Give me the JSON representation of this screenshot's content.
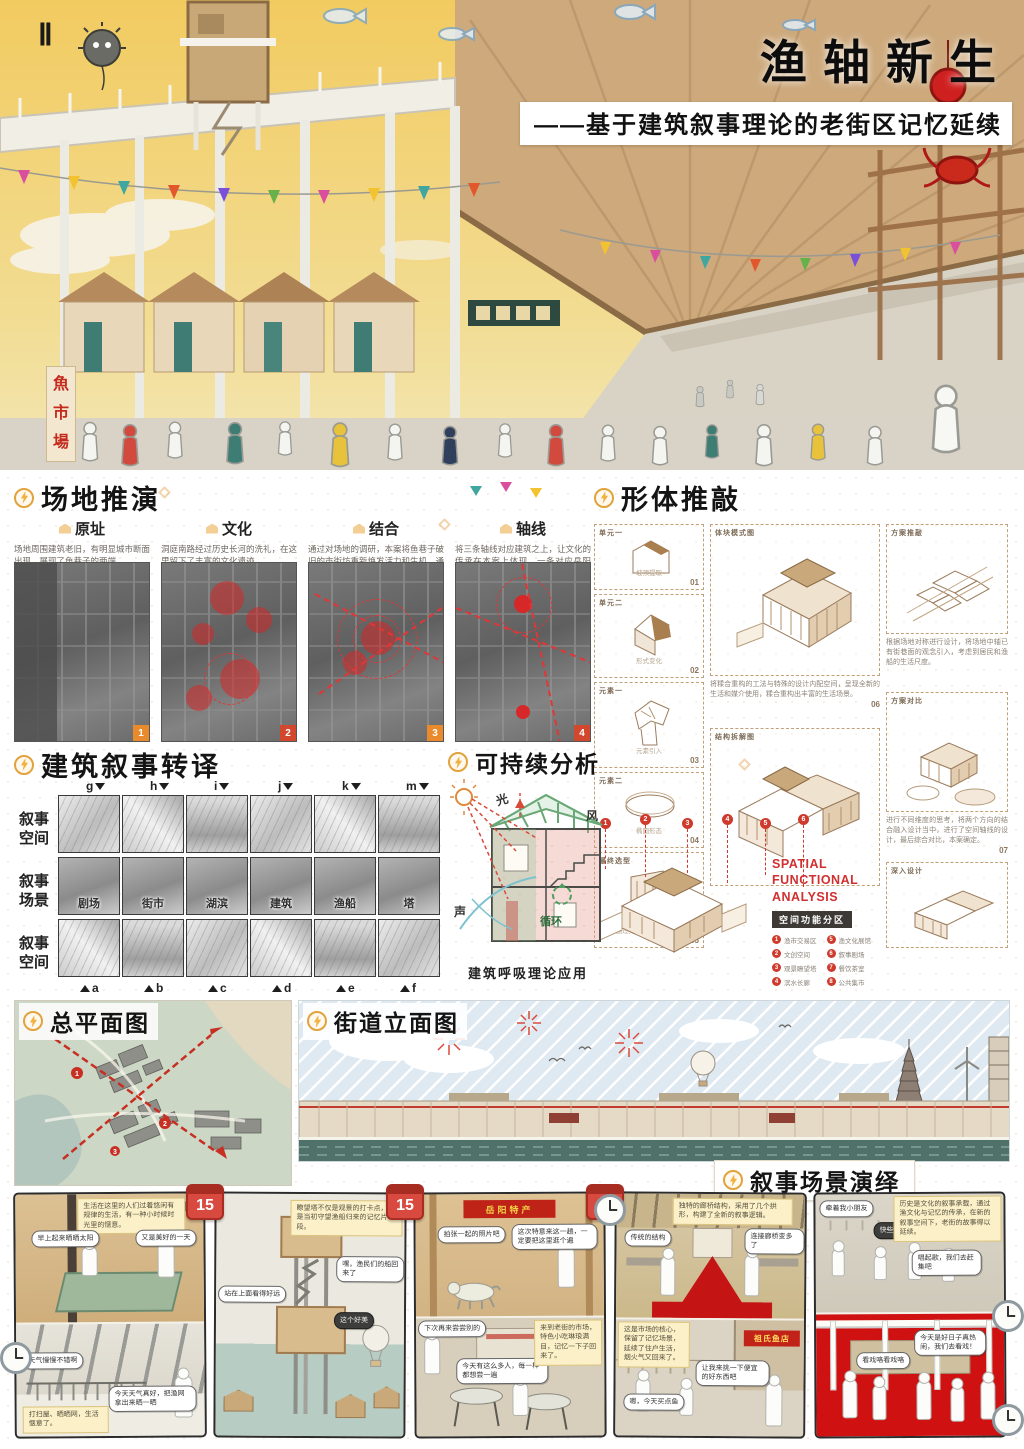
{
  "hero": {
    "numeral": "Ⅱ",
    "title": "渔轴新生",
    "subtitle": "——基于建筑叙事理论的老街区记忆延续",
    "market_sign": [
      "魚",
      "市",
      "場"
    ]
  },
  "site": {
    "title": "场地推演",
    "items": [
      {
        "label": "原址",
        "text": "场地周围建筑老旧，有明显城市断面出现，展现了鱼巷子的两端。",
        "num": "1"
      },
      {
        "label": "文化",
        "text": "洞庭南路经过历史长河的洗礼，在这里留下了丰富的文化遗迹。",
        "num": "2"
      },
      {
        "label": "结合",
        "text": "通过对场地的调研，本案将鱼巷子破旧的市街坊重新焕发活力和生机，通过本案打破断面的现象。",
        "num": "3"
      },
      {
        "label": "轴线",
        "text": "将三条轴线对应建筑之上，让文化的传承在本案上体现，一条对应岳阳楼，一条对应慈氏塔，一条对应城市轴线。",
        "num": "4"
      }
    ]
  },
  "form": {
    "title": "形体推敲",
    "steps": [
      {
        "label": "单元一",
        "caption": "坡顶提取",
        "num": "01"
      },
      {
        "label": "单元二",
        "caption": "形式变化",
        "num": "02"
      },
      {
        "label": "元素一",
        "caption": "元素引入",
        "num": "03"
      },
      {
        "label": "元素二",
        "caption": "椭圆形态",
        "num": "04"
      },
      {
        "label": "最终选型",
        "caption": "通过对比筛选 设计确定",
        "num": "05"
      }
    ],
    "mass_label": "体块模式图",
    "mass_text": "将糅合重构的工法与特殊的设计内配空间，呈现全新的生活和媒介使用，糅合重构出丰富的生活场景。",
    "mass_num": "06",
    "structure_label": "结构拆解图",
    "scheme_label": "方案推敲",
    "scheme_text": "根据场地对称进行设计，将场地中轴已有街巷面的观念引入，考虑到居民和渔船的生活尺度。",
    "compare_label": "方案对比",
    "compare_text": "进行不同维度的思考，将两个方向的结合融入设计当中，进行了空间轴线的设计，最后综合对比，本案确定。",
    "compare_num": "07",
    "deep_label": "深入设计",
    "spatial": {
      "en1": "SPATIAL",
      "en2": "FUNCTIONAL ANALYSIS",
      "zh": "空间功能分区",
      "legend": [
        {
          "num": "1",
          "label": "渔市交易区"
        },
        {
          "num": "2",
          "label": "文创空间"
        },
        {
          "num": "3",
          "label": "观景瞭望塔"
        },
        {
          "num": "4",
          "label": "滨水长廊"
        },
        {
          "num": "5",
          "label": "渔文化展馆"
        },
        {
          "num": "6",
          "label": "叙事剧场"
        },
        {
          "num": "7",
          "label": "餐饮茶室"
        },
        {
          "num": "8",
          "label": "公共集市"
        }
      ]
    }
  },
  "narrative": {
    "title": "建筑叙事转译",
    "rows": [
      "叙事空间",
      "叙事场景",
      "叙事空间"
    ],
    "top_letters": [
      "g",
      "h",
      "i",
      "j",
      "k",
      "m"
    ],
    "bottom_letters": [
      "a",
      "b",
      "c",
      "d",
      "e",
      "f"
    ],
    "scenes": [
      "剧场",
      "街市",
      "湖滨",
      "建筑",
      "渔船",
      "塔"
    ]
  },
  "sustain": {
    "title": "可持续分析",
    "light": "光",
    "wind": "风",
    "sound": "声",
    "cycle": "循环",
    "caption": "建筑呼吸理论应用"
  },
  "masterplan": {
    "title": "总平面图"
  },
  "elevation": {
    "title": "街道立面图"
  },
  "scenes": {
    "title": "叙事场景演绎",
    "calendar_day": "15",
    "panels": [
      {
        "caption": "生活在这里的人们过着悠闲有规律的生活，有一种小时候时光里的惬意。",
        "b1": "早上起来晒晒太阳",
        "b2": "又是美好的一天",
        "b3": "天气慢慢不错啊",
        "b4": "今天天气真好，把渔网拿出来晒一晒",
        "b5": "打扫屋、晒晒网，生活惬意了。"
      },
      {
        "caption": "瞭望塔不仅是观景的打卡点，更是当初守望渔船归来的记忆片段。",
        "b1": "站在上面看得好远",
        "b2": "嘿，渔民们的船回来了",
        "b3": "这个好美"
      },
      {
        "sign": "岳阳特产",
        "caption": "来到老街的市场，特色小吃琳琅满目，记忆一下子回来了。",
        "b1": "拍张一起的照片吧",
        "b2": "这次特意来这一趟，一定要把这里逛个遍",
        "b3": "下次再来尝尝别的",
        "b4": "今天有这么多人，每一样都想尝一遍"
      },
      {
        "sign": "祖氏鱼店",
        "caption": "独特的廊桥结构，采用了几个拱形，构建了全新的叙事逻辑。",
        "caption2": "这是市场的核心，保留了记忆场景，延续了住户生活，烟火气又回来了。",
        "b1": "传统的结构",
        "b2": "连接廊桥变多了",
        "b3": "嗯，今天买点鱼",
        "b4": "让我来挑一下便宜的好东西吧"
      },
      {
        "caption": "历史是文化的叙事承载，通过渔文化与记忆的传承，在新的叙事空间下，老街的故事得以延续。",
        "b1": "牵着我小朋友",
        "b2": "快些快些",
        "b3": "唱起歌，我们去赶集吧",
        "b4": "今天是好日子真热闹，我们去看戏！",
        "b5": "看戏咯看戏咯"
      }
    ]
  }
}
